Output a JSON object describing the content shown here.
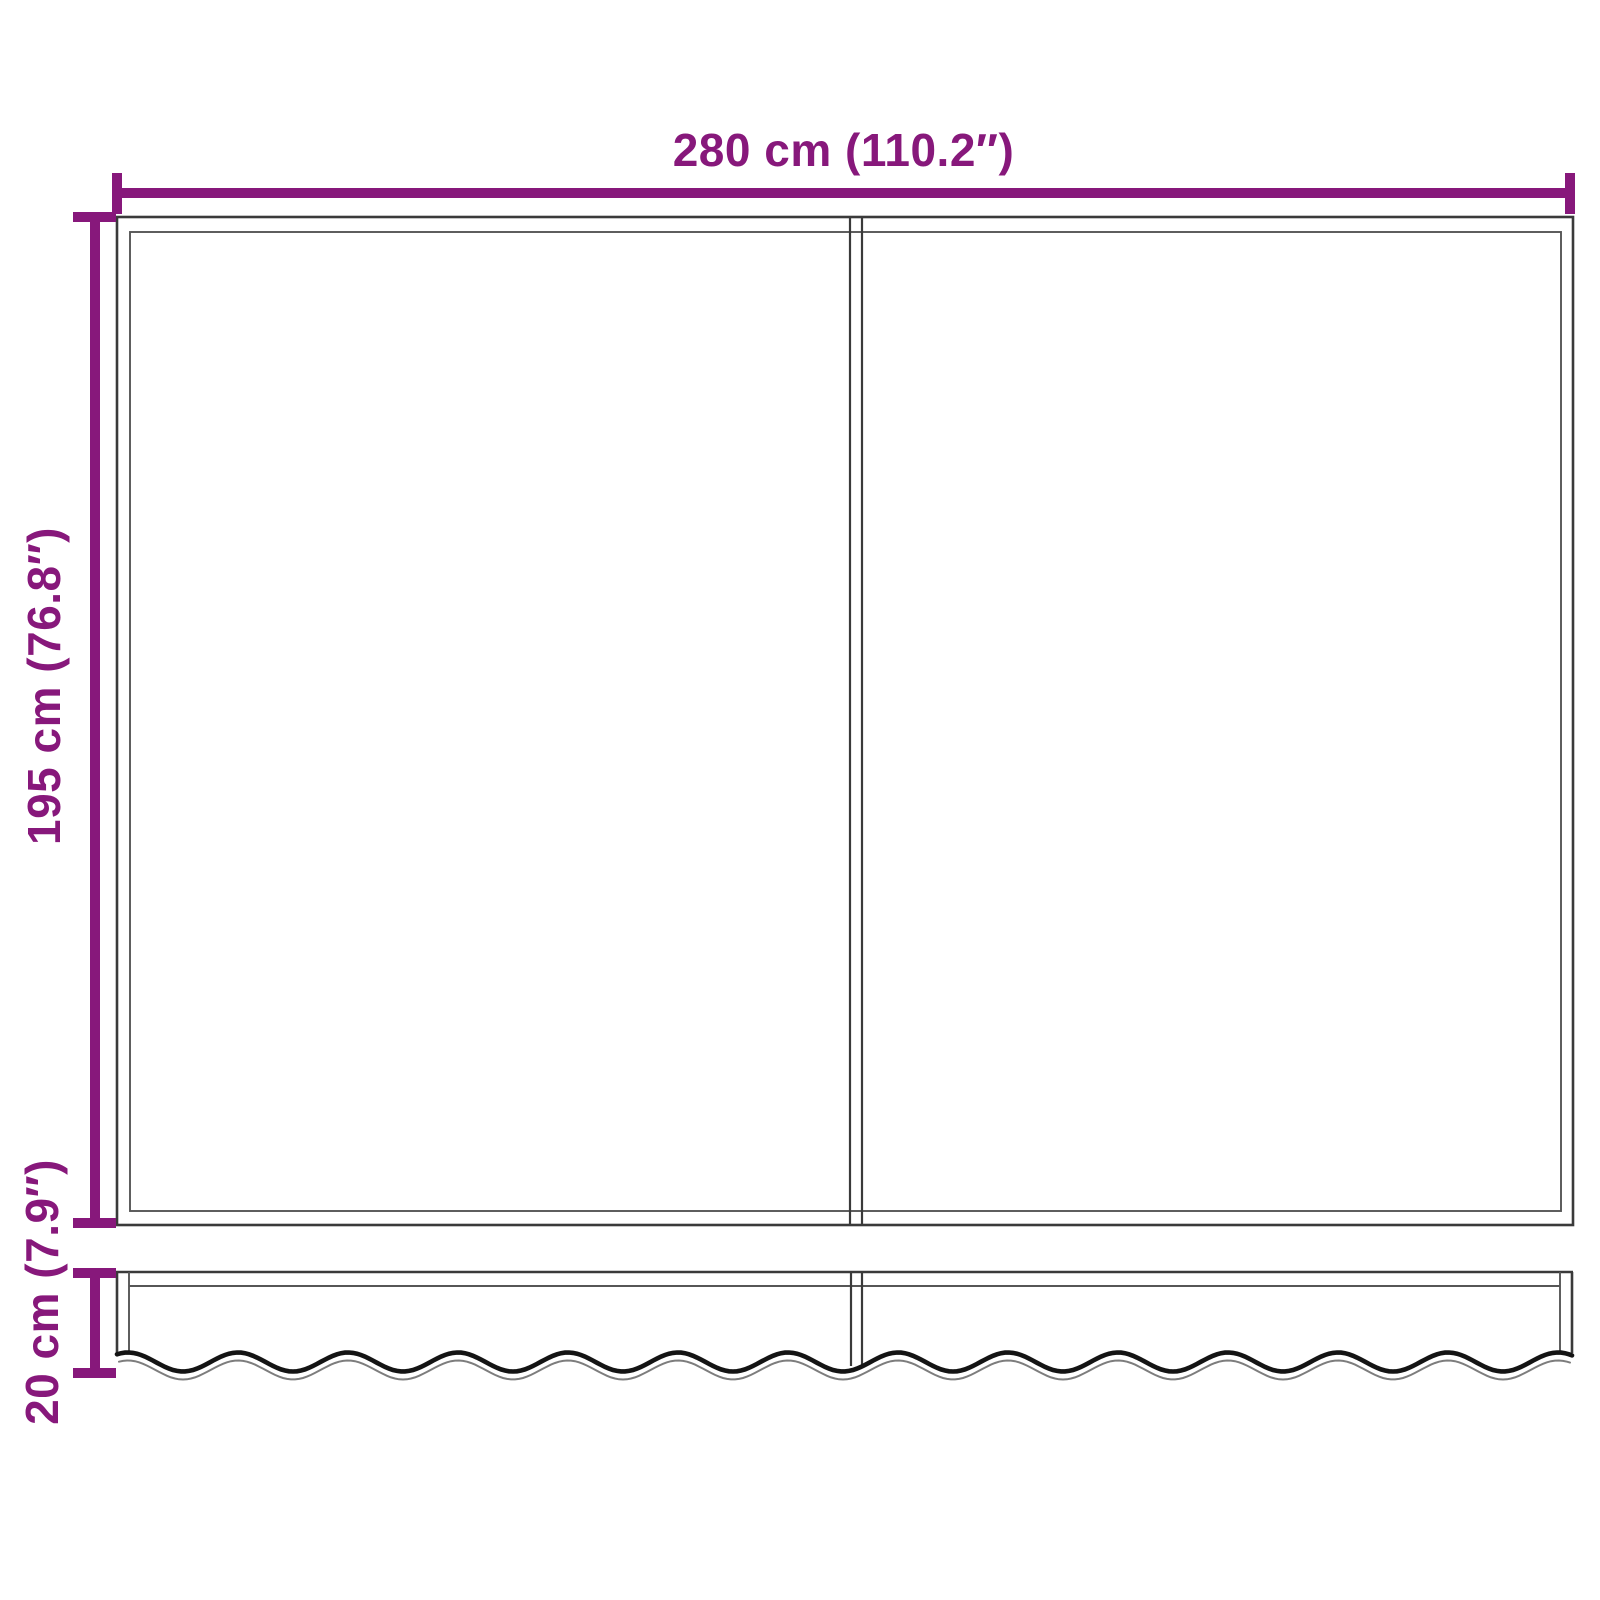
{
  "dimensions": {
    "width": {
      "label": "280 cm (110.2″)",
      "cm": "280",
      "inches": "110.2"
    },
    "height": {
      "label": "195 cm (76.8″)",
      "cm": "195",
      "inches": "76.8"
    },
    "valance_height": {
      "label": "20 cm (7.9″)",
      "cm": "20",
      "inches": "7.9"
    }
  },
  "colors": {
    "dimension_accent": "#87187b",
    "outline": "#3a3a3a",
    "outline_light": "#565656",
    "scallop_edge": "#141414",
    "scallop_shadow": "#7d7d7d",
    "background": "#ffffff"
  }
}
